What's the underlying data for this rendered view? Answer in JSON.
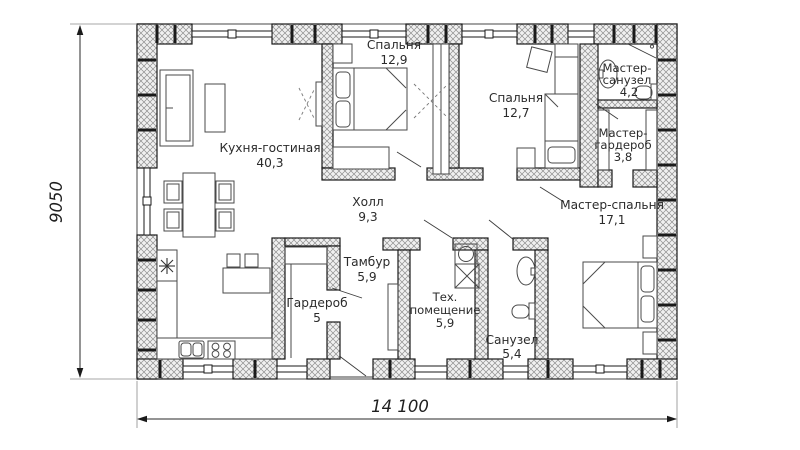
{
  "document": {
    "type": "floor-plan"
  },
  "dimensions": {
    "horizontal": "14 100",
    "vertical": "9050"
  },
  "rooms": [
    {
      "name": "Кухня-гостиная",
      "area": "40,3"
    },
    {
      "name": "Спальня",
      "area": "12,9"
    },
    {
      "name": "Спальня",
      "area": "12,7"
    },
    {
      "line1": "Мастер-",
      "line2": "санузел",
      "area": "4,2"
    },
    {
      "line1": "Мастер-",
      "line2": "гардероб",
      "area": "3,8"
    },
    {
      "name": "Мастер-спальня",
      "area": "17,1"
    },
    {
      "name": "Холл",
      "area": "9,3"
    },
    {
      "name": "Тамбур",
      "area": "5,9"
    },
    {
      "name": "Гардероб",
      "area": "5"
    },
    {
      "line1": "Тех.",
      "line2": "помещение",
      "area": "5,9"
    },
    {
      "name": "Санузел",
      "area": "5,4"
    }
  ],
  "colors": {
    "wall_hatch": "#8f8f8f",
    "wall_fill": "#f0f0f0",
    "line": "#1a1a1a",
    "text": "#2b2b2b",
    "background": "#ffffff"
  }
}
